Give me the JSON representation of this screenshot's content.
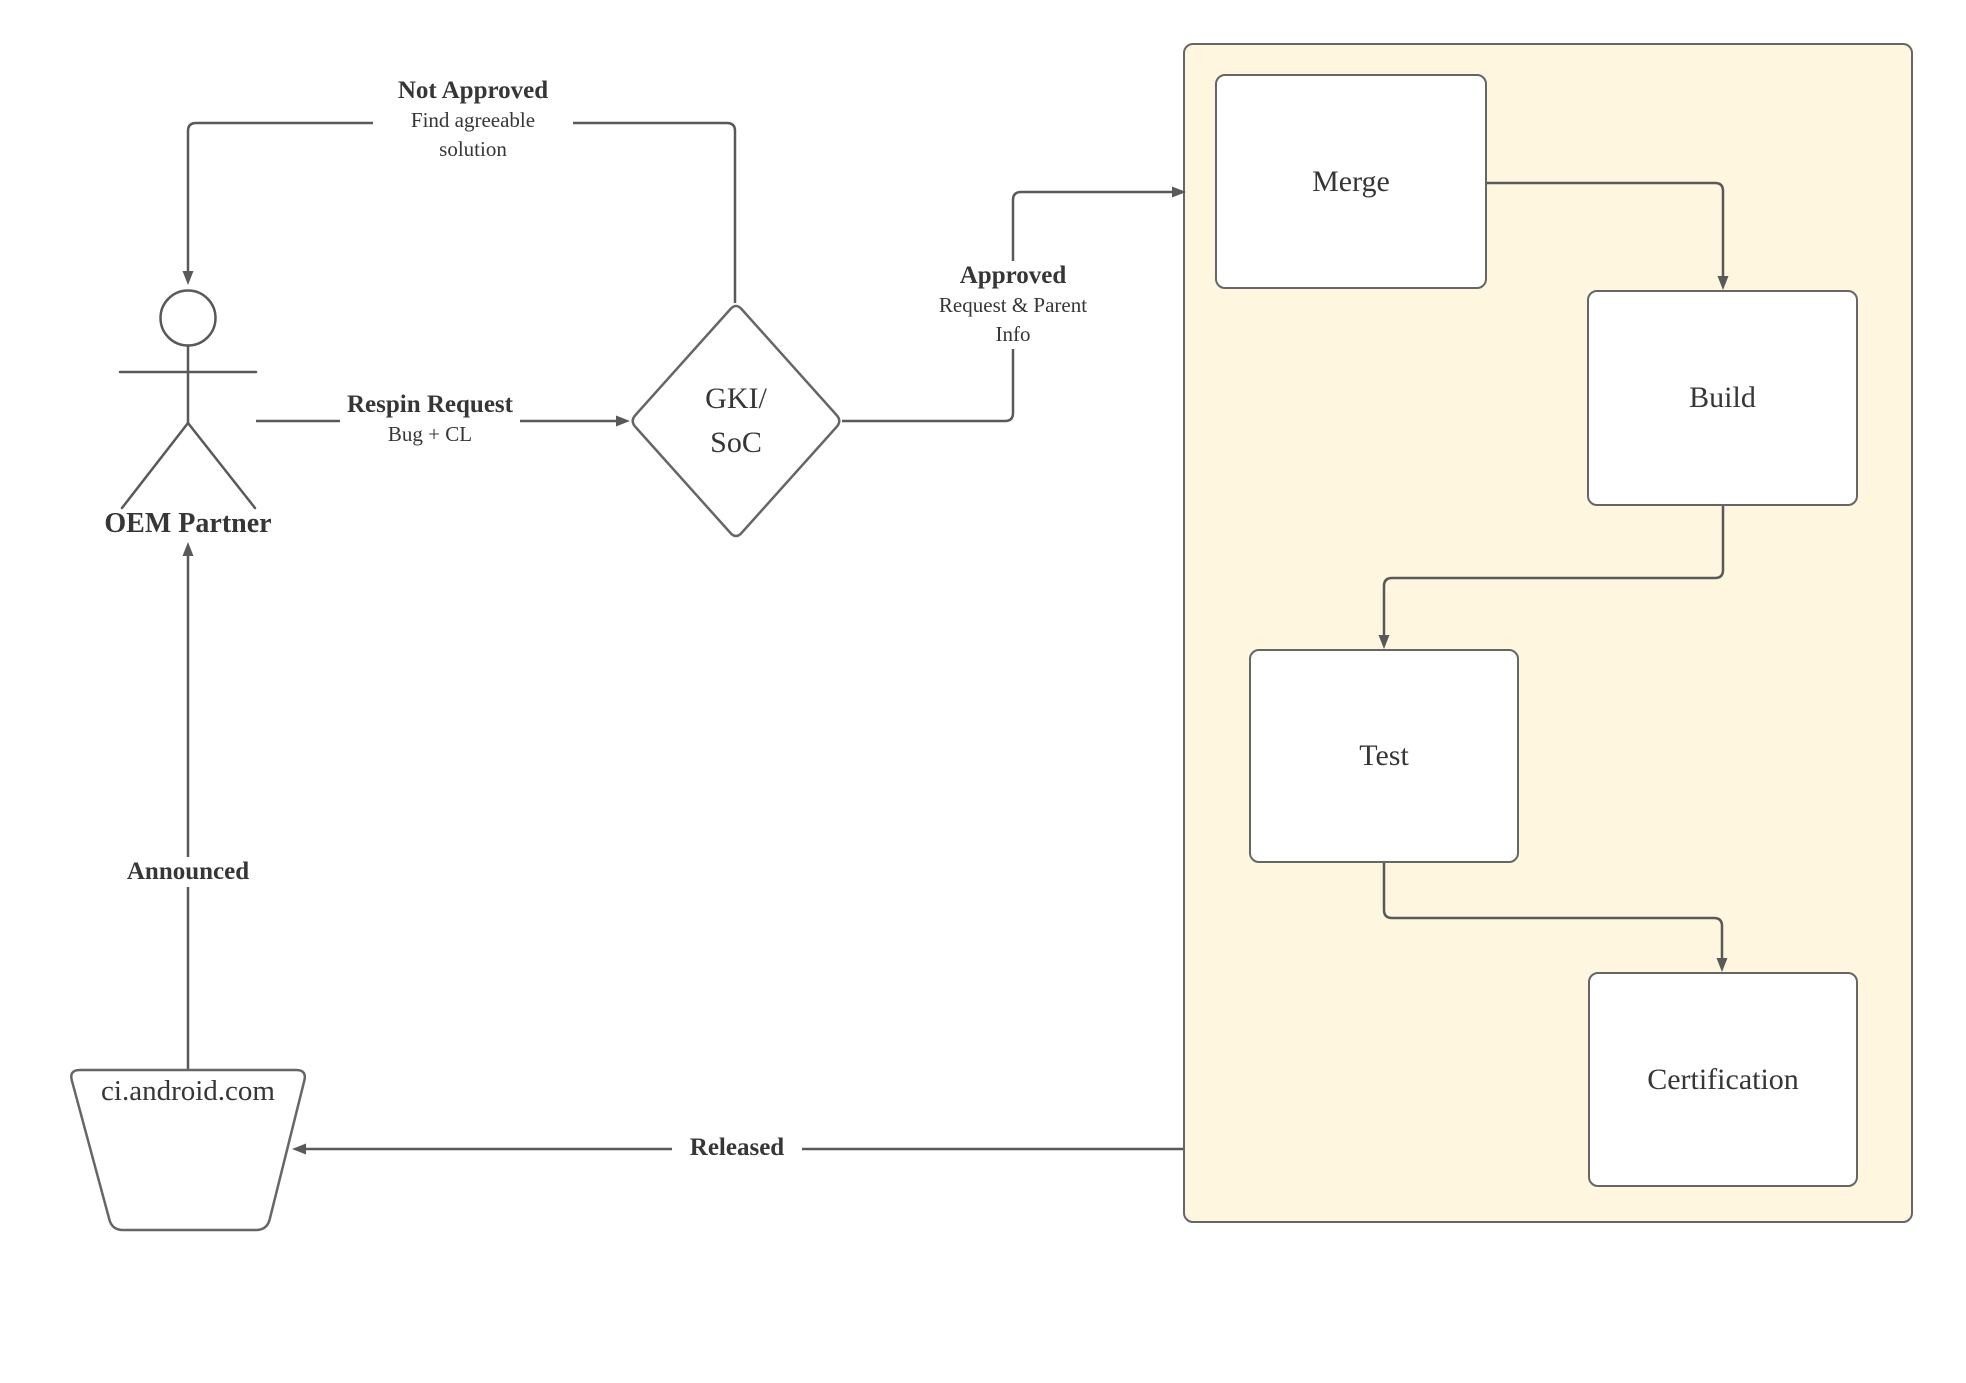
{
  "nodes": {
    "actor_label": "OEM Partner",
    "decision_line1": "GKI/",
    "decision_line2": "SoC",
    "datastore_label": "ci.android.com"
  },
  "pipeline": {
    "steps": [
      {
        "label": "Merge"
      },
      {
        "label": "Build"
      },
      {
        "label": "Test"
      },
      {
        "label": "Certification"
      }
    ]
  },
  "edges": {
    "not_approved": {
      "title": "Not Approved",
      "subtitle_line1": "Find agreeable",
      "subtitle_line2": "solution"
    },
    "respin": {
      "title": "Respin Request",
      "subtitle": "Bug + CL"
    },
    "approved": {
      "title": "Approved",
      "subtitle_line1": "Request & Parent",
      "subtitle_line2": "Info"
    },
    "announced": {
      "title": "Announced"
    },
    "released": {
      "title": "Released"
    }
  },
  "colors": {
    "background": "#ffffff",
    "container_fill": "#fff6e0",
    "shape_fill": "#ffffff",
    "shape_border": "#666666",
    "line": "#595959",
    "text": "#363636"
  }
}
